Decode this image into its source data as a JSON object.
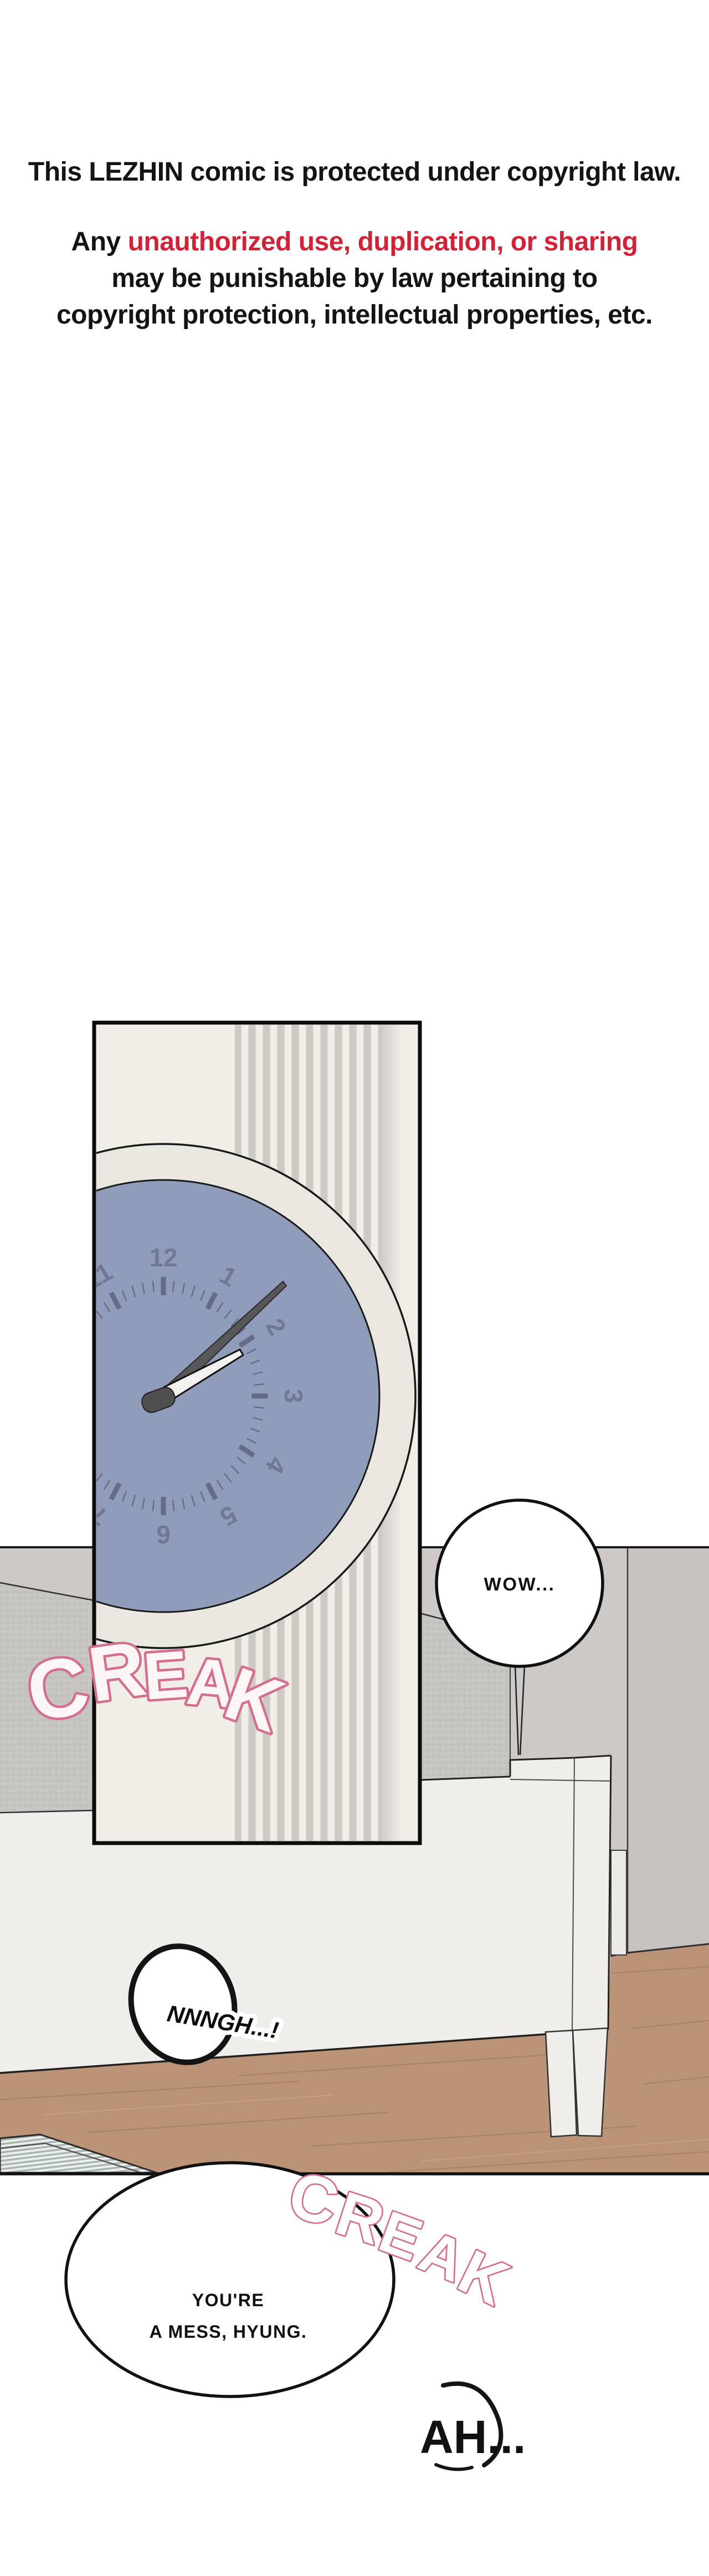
{
  "copyright": {
    "line1": "This LEZHIN comic is protected under copyright law.",
    "line2_prefix": "Any ",
    "line2_highlight": "unauthorized use, duplication, or sharing",
    "line3": "may be punishable by law pertaining to",
    "line4": "copyright protection, intellectual properties, etc."
  },
  "colors": {
    "highlight_red": "#d02337",
    "sfx_pink_outline": "#d4708f",
    "sfx_fill": "#fdf6f6",
    "panel_background": "#f1eee8",
    "wall_stripe_gray": "#cdcac6",
    "clock_face_blue": "#8f9cba",
    "clock_rim_cream": "#eae7e0",
    "clock_marks_gray": "#5d6480",
    "room_wall_gray": "#cdc9c6",
    "mattress_gray": "#c6c5c2",
    "bed_white": "#efeeea",
    "floor_wood": "#bb9478",
    "rug_stripe": "#a9b6b2"
  },
  "panel": {
    "clock": {
      "numbers": [
        "12",
        "1",
        "2",
        "3",
        "4",
        "5",
        "6",
        "7",
        "8",
        "9",
        "10",
        "11"
      ]
    }
  },
  "sfx": {
    "creak1": {
      "word": "CREAK",
      "letters": [
        "C",
        "R",
        "E",
        "A",
        "K"
      ]
    },
    "creak2": {
      "word": "CREAK",
      "letters": [
        "C",
        "R",
        "E",
        "A",
        "K"
      ]
    }
  },
  "bubbles": {
    "wow": "WOW...",
    "nnngh": "NNNGH...!",
    "mess_line1": "YOU'RE",
    "mess_line2": "A MESS, HYUNG.",
    "ah": "AH..."
  }
}
